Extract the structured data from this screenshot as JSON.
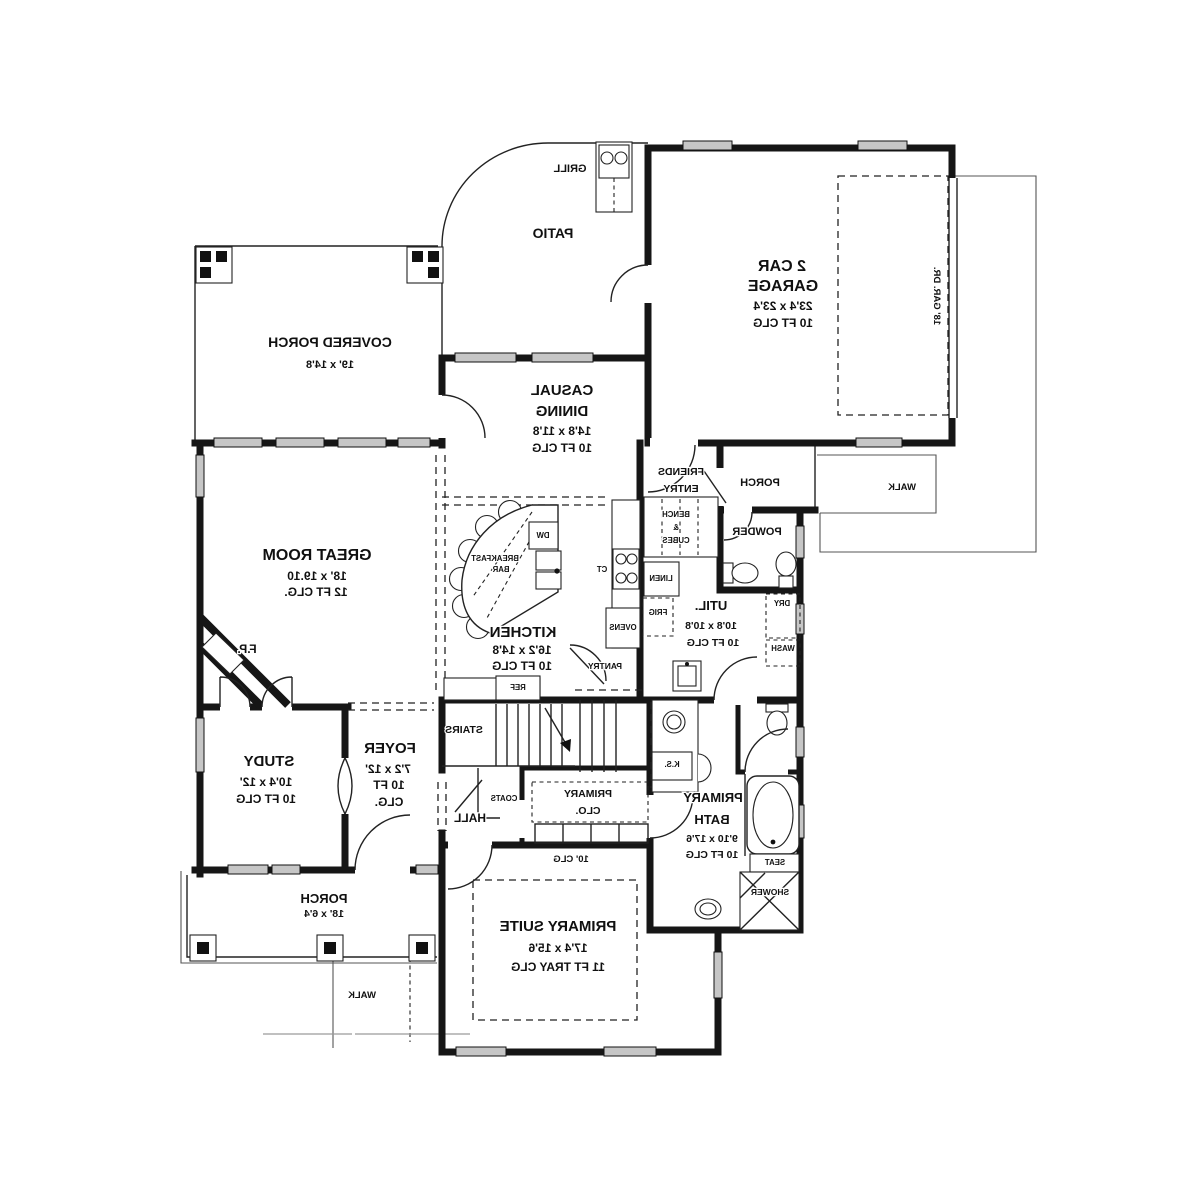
{
  "plan": {
    "garage": {
      "l1": "2 CAR",
      "l2": "GARAGE",
      "dims": "23'4 x 23'4",
      "clg": "10 FT CLG",
      "door": "18' GAR. DR."
    },
    "patio": {
      "name": "PATIO",
      "grill": "GRILL"
    },
    "covered_porch": {
      "name": "COVERED PORCH",
      "dims": "19' x 14'8"
    },
    "casual_dining": {
      "l1": "CASUAL",
      "l2": "DINING",
      "dims": "14'8 x 11'8",
      "clg": "10 FT CLG"
    },
    "great_room": {
      "name": "GREAT ROOM",
      "dims": "18' x 19.10",
      "clg": "12 FT CLG.",
      "fireplace": "F.P."
    },
    "kitchen": {
      "name": "KITCHEN",
      "dims": "16'2 x 14'8",
      "clg": "10 FT CLG",
      "breakfast_l1": "BREAKFAST",
      "breakfast_l2": "BAR",
      "dw": "DW",
      "ref": "REF",
      "pantry": "PANTRY",
      "ct": "CT",
      "ovens": "OVENS"
    },
    "friends_entry": {
      "l1": "FRIENDS",
      "l2": "ENTRY",
      "bench_l1": "BENCH",
      "bench_l2": "&",
      "bench_l3": "CUBES"
    },
    "porch_right": {
      "name": "PORCH"
    },
    "powder": {
      "name": "POWDER"
    },
    "util": {
      "name": "UTIL.",
      "dims": "10'8 x 10'8",
      "clg": "10 FT CLG",
      "linen": "LINEN",
      "frig": "FRIG",
      "dry": "DRY",
      "wash": "WASH"
    },
    "stairs": {
      "name": "STAIRS"
    },
    "hall": {
      "name": "HALL",
      "coats": "COATS"
    },
    "primary_clo": {
      "l1": "PRIMARY",
      "l2": "CLO."
    },
    "study": {
      "name": "STUDY",
      "dims": "10'4 x 12'",
      "clg": "10 FT CLG"
    },
    "foyer": {
      "l1": "FOYER",
      "l2": "7'2 x 12'",
      "l3": "10 FT",
      "l4": "CLG."
    },
    "porch_front": {
      "name": "PORCH",
      "dims": "18' x 6'4",
      "walk": "WALK"
    },
    "primary_suite": {
      "name": "PRIMARY SUITE",
      "dims": "17'4 x 15'6",
      "clg": "11 FT TRAY CLG",
      "perimeter_clg": "10' CLG"
    },
    "primary_bath": {
      "l1": "PRIMARY",
      "l2": "BATH",
      "dims": "9'10 x 17'6",
      "clg": "10 FT CLG",
      "ks": "K.S.",
      "seat": "SEAT",
      "shower": "SHOWER"
    },
    "walk_right": {
      "walk": "WALK"
    }
  },
  "colors": {
    "line": "#161616",
    "window_fill": "#c6c6c6",
    "background": "#ffffff"
  }
}
